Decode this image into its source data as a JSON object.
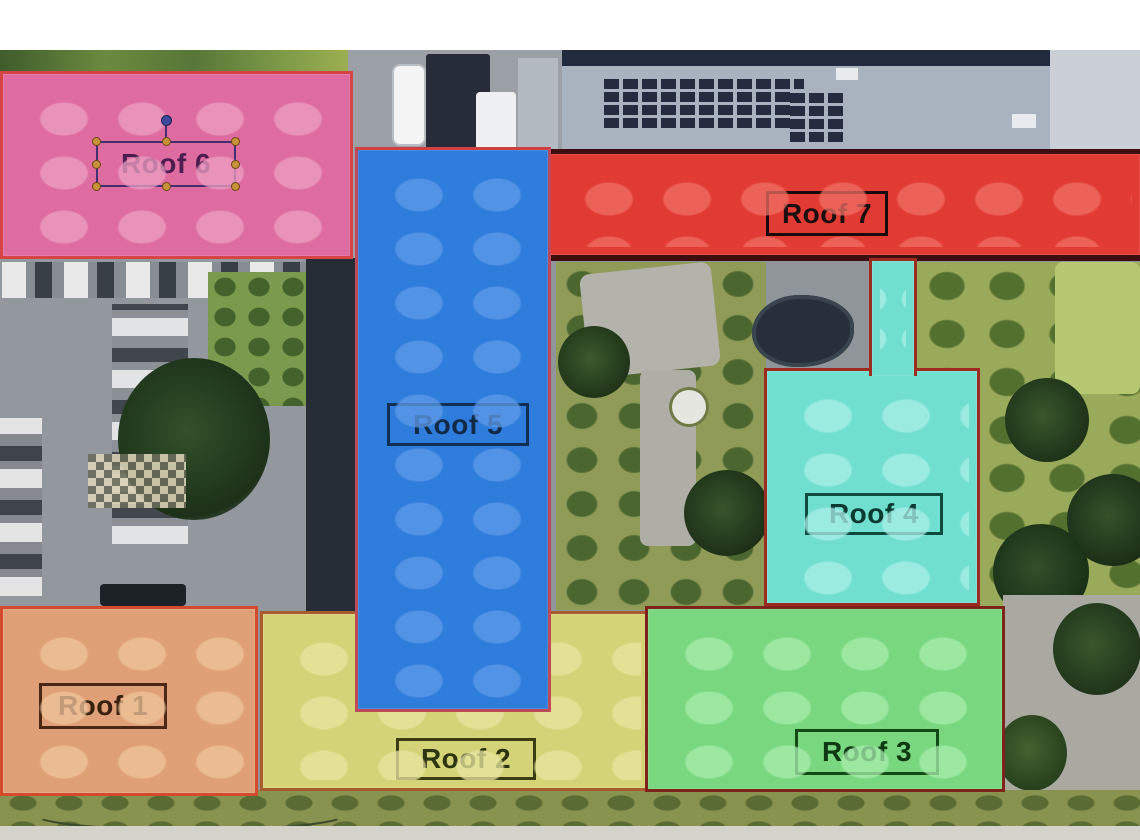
{
  "image_type": "aerial-roof-annotation",
  "roofs": [
    {
      "label": "Roof 1",
      "color": "#e0a077"
    },
    {
      "label": "Roof 2",
      "color": "#d5d377"
    },
    {
      "label": "Roof 3",
      "color": "#79d77f"
    },
    {
      "label": "Roof 4",
      "color": "#70dfd0"
    },
    {
      "label": "Roof 5",
      "color": "#2e7cdb"
    },
    {
      "label": "Roof 6",
      "color": "#df6ca0"
    },
    {
      "label": "Roof 7",
      "color": "#e23b33"
    }
  ],
  "selection": {
    "selected": "Roof 6",
    "handle_color": "#c8923a",
    "rotation_handle_color": "#3b4a9c"
  }
}
